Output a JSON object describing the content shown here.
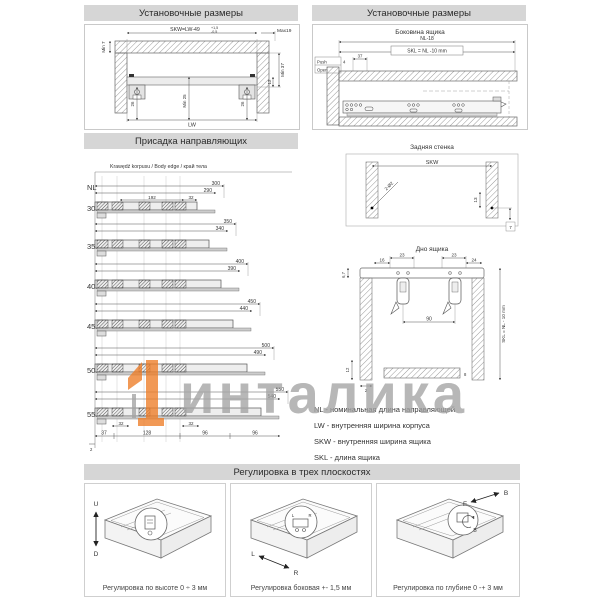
{
  "colors": {
    "header_bg": "#d6d6d6",
    "line_dark": "#444444",
    "hatch_gray": "#999999",
    "watermark_gray": "#a3a3a3",
    "watermark_orange": "#ee7d27"
  },
  "watermark": {
    "text": "инталика"
  },
  "sections": {
    "install_left": {
      "title": "Установочные размеры",
      "dims": {
        "skw_formula": "SKW=LW-49",
        "tol_plus": "+1,5",
        "tol_minus": "-0,5",
        "max19": "Max19",
        "min7": "Min 7",
        "min37": "Min 37",
        "d12": "12",
        "d26l": "26",
        "d26r": "26",
        "min25": "Min 25",
        "lw": "LW"
      }
    },
    "install_right": {
      "title": "Установочные размеры",
      "subtitle": "Боковина ящика",
      "dims": {
        "nl18": "NL-18",
        "skl": "SKL = NL -10 mm",
        "push": "Push",
        "open": "Open",
        "d4": "4",
        "d37": "37"
      }
    },
    "drilling": {
      "title": "Присадка направляющих",
      "edge_label": "Krawędź korpusu / Body edge / край тела",
      "nl": "NL",
      "rows": [
        {
          "nl": "300",
          "len": "300",
          "len2": "290",
          "d192": "192",
          "d32": "32"
        },
        {
          "nl": "350",
          "len": "350",
          "len2": "340"
        },
        {
          "nl": "400",
          "len": "400",
          "len2": "390"
        },
        {
          "nl": "450",
          "len": "450",
          "len2": "440"
        },
        {
          "nl": "500",
          "len": "500",
          "len2": "490"
        },
        {
          "nl": "550",
          "len": "550",
          "len2": "540",
          "d32a": "32",
          "d32b": "32"
        }
      ],
      "chain": {
        "d2": "2",
        "d37": "37",
        "d128": "128",
        "d96a": "96",
        "d96b": "96"
      }
    },
    "back_wall": {
      "title": "Задняя стенка",
      "dims": {
        "skw": "SKW",
        "holes": "2-Ø2",
        "d13": "13",
        "d7": "7"
      }
    },
    "drawer_bottom": {
      "title": "Дно ящика",
      "dims": {
        "d23a": "23",
        "d23b": "23",
        "d16": "16",
        "d24": "24",
        "d67": "6,7",
        "d90": "90",
        "skl": "SKL = NL - 10 mm",
        "d12": "12",
        "d2": "2",
        "d8": "8"
      }
    },
    "legend": {
      "line1": "NL - номинальная длина направляющей",
      "line2": "LW - внутренняя ширина корпуса",
      "line3": "SKW - внутренняя ширина ящика",
      "line4": "SKL - длина ящика"
    },
    "adjustment": {
      "title": "Регулировка в трех плоскостях",
      "items": [
        {
          "caption": "Регулировка по высоте 0 ÷ 3 мм",
          "label_a": "U",
          "label_b": "D"
        },
        {
          "caption": "Регулировка боковая +- 1,5 мм",
          "label_a": "L",
          "label_b": "R"
        },
        {
          "caption": "Регулировка по глубине 0 -+ 3 мм",
          "label_a": "F",
          "label_b": "B"
        }
      ]
    }
  }
}
